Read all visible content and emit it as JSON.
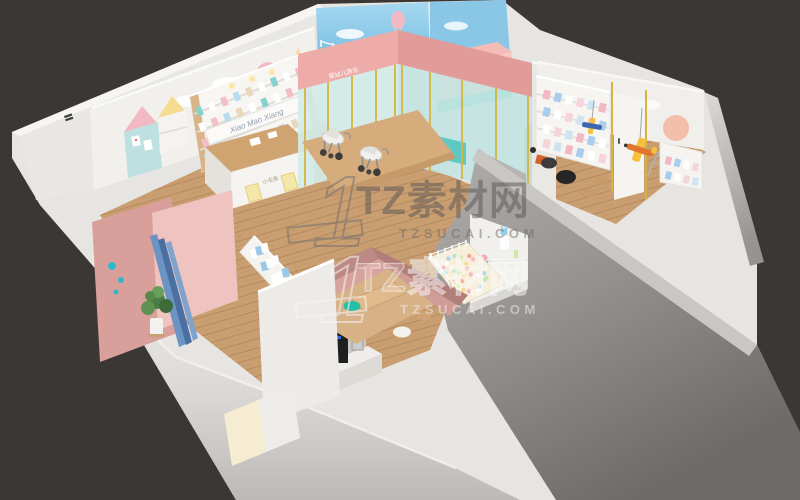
{
  "scene": {
    "watermark_row1": {
      "logo": "1",
      "brand": "TZ素材网",
      "site": "TZSUCAI.COM"
    },
    "watermark_row2": {
      "logo": "1",
      "brand": "TZ素材网",
      "site": "TZSUCAI.COM"
    },
    "signs": {
      "storefront_left": "婴幼儿游泳",
      "storefront_right": "婴幼儿游泳",
      "shelf_banner": "Xiao Mao Xiang",
      "counter": "小毛象"
    },
    "palette": {
      "background": "#3a3735",
      "wall_white": "#eceae6",
      "wall_cap": "#f6f5f2",
      "wood_floor": "#c99e71",
      "storefront_pink": "#eeaca8",
      "pool_teal": "#5ec8c5",
      "sky_mural": "#8ec9e9",
      "cut_wall_gray": "#9b9997",
      "banquette_pink": "#c08a84",
      "accent_teal": "#27bda6",
      "frame_gold": "#d9b340",
      "slide_blue": "#5b84b8"
    }
  }
}
